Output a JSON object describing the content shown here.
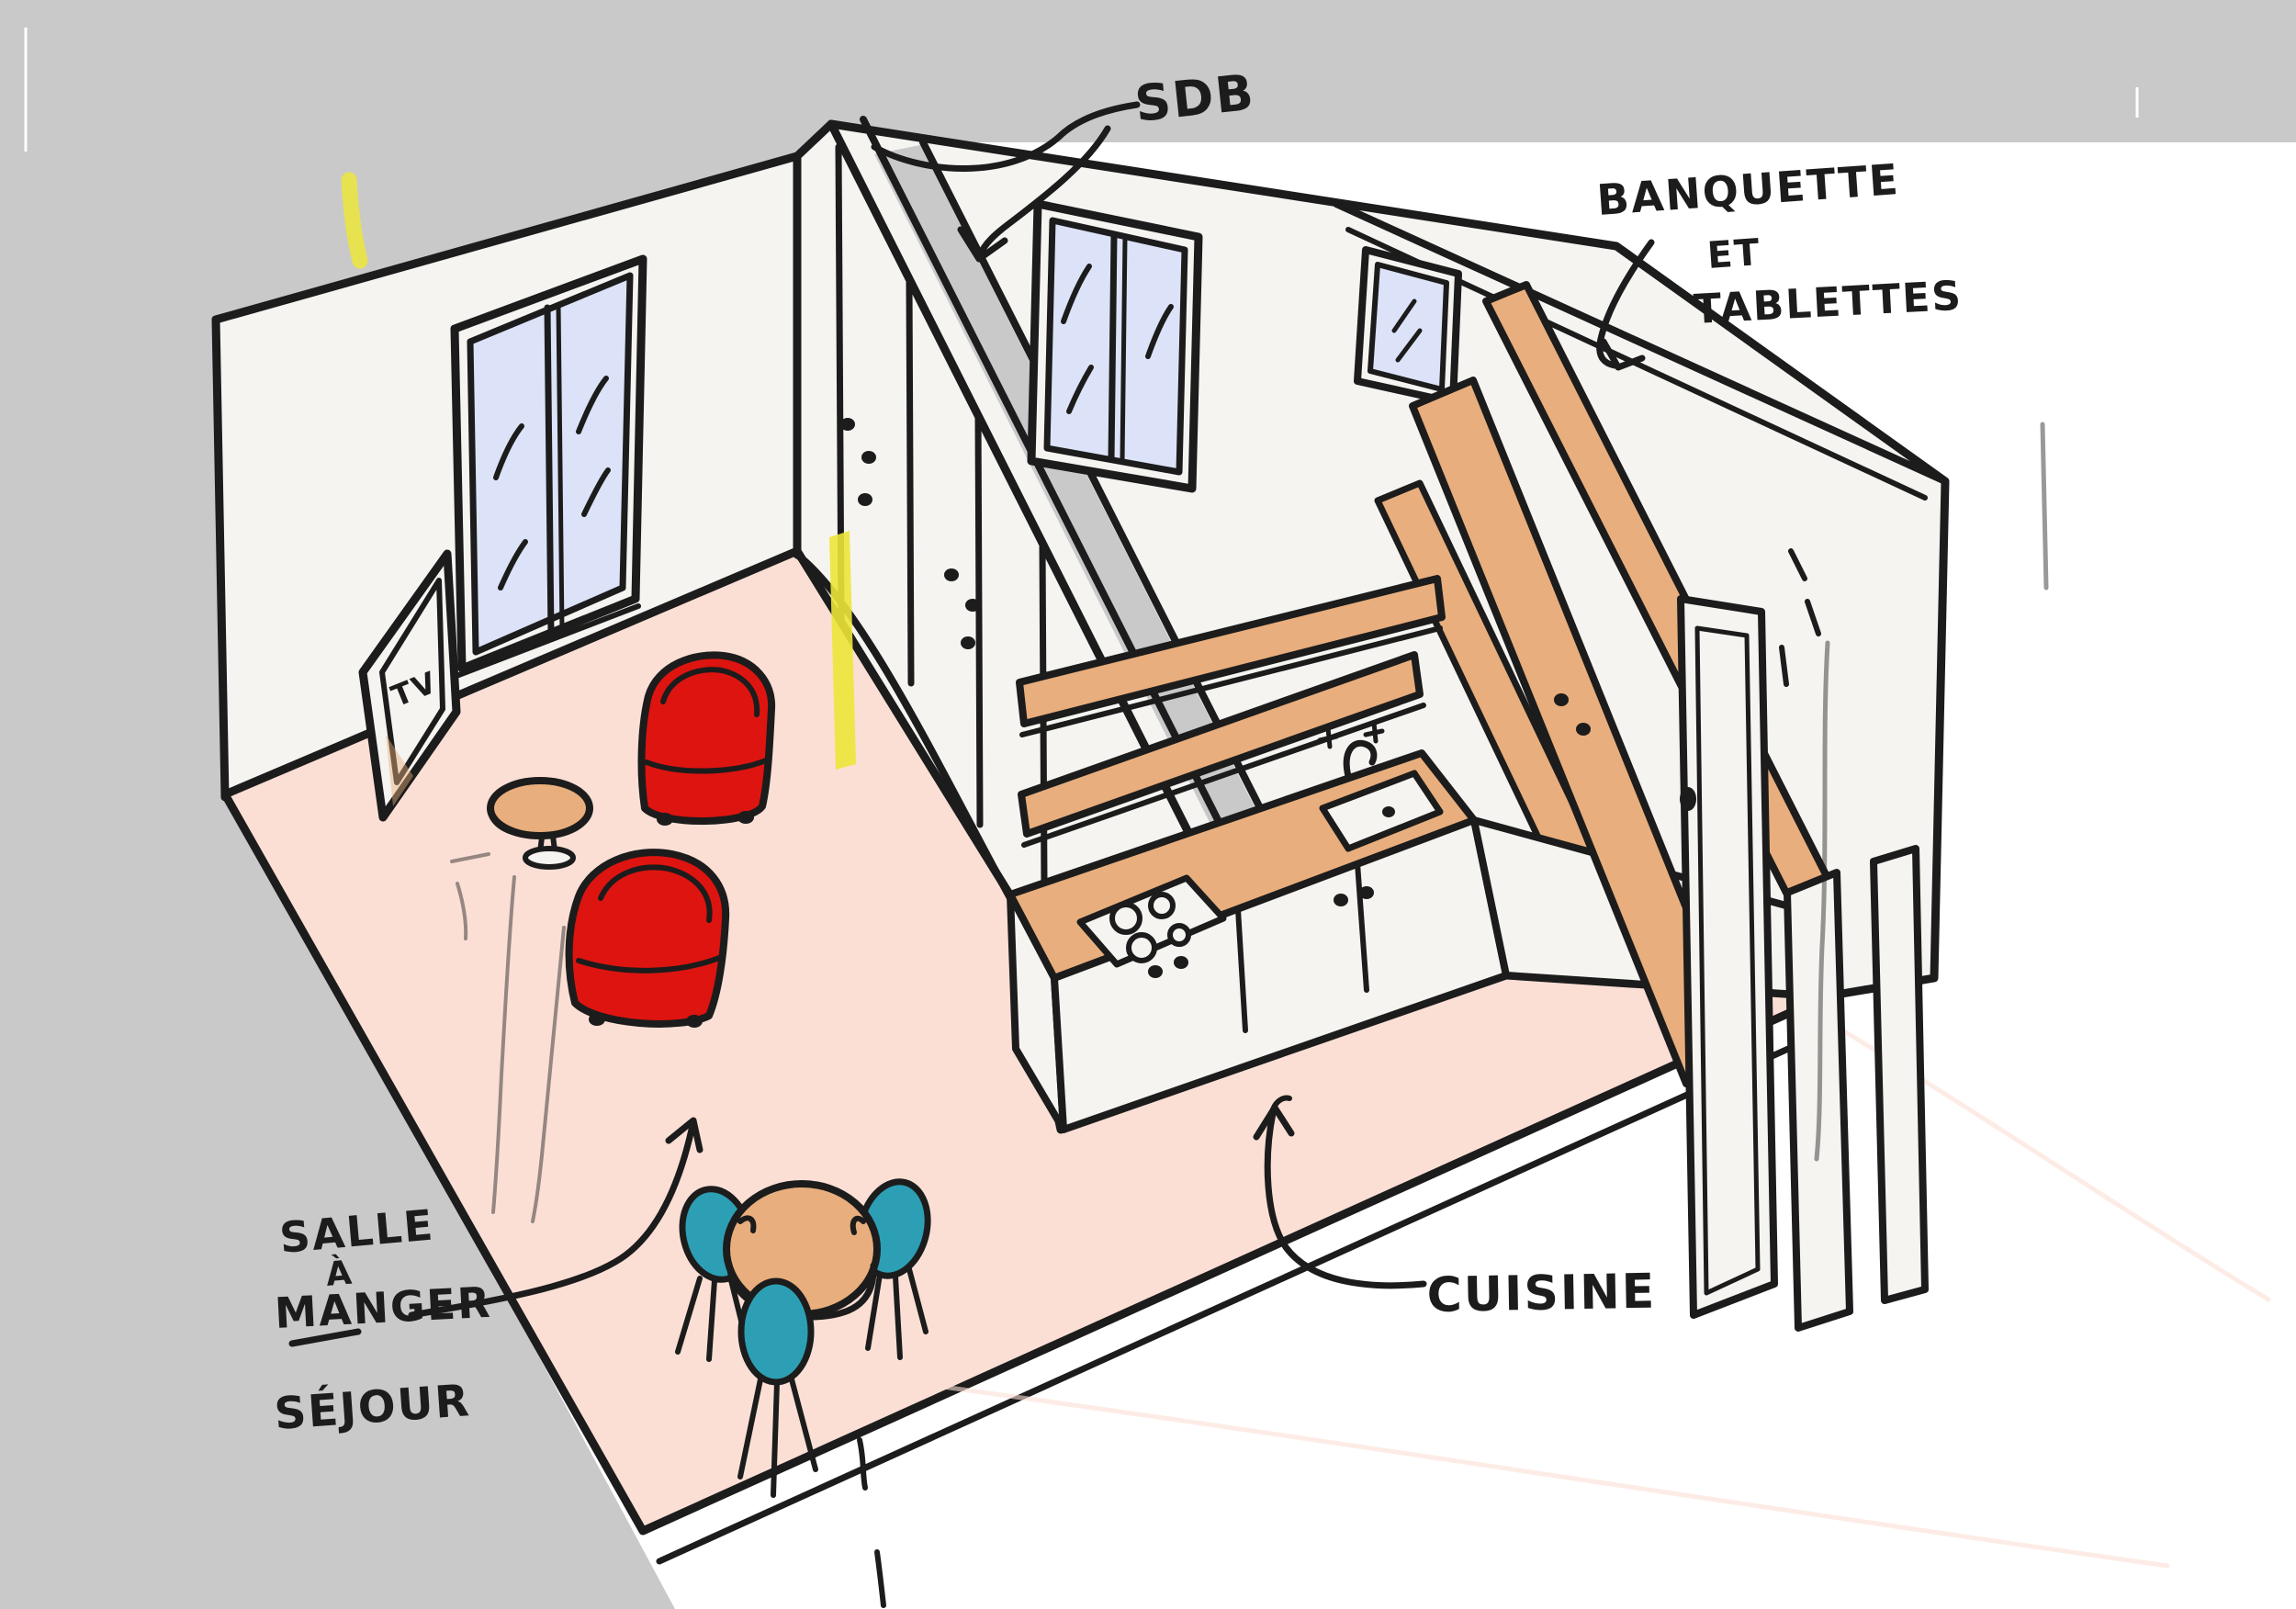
{
  "scene": {
    "type": "interior-design-sketch",
    "style": "hand-drawn isometric marker sketch",
    "subject": "small apartment layout with living room, dining area, kitchen, bathroom and banquette shelving"
  },
  "labels": {
    "bathroom": "SDB",
    "banquette_line1": "BANQUETTE",
    "banquette_line2": "ET",
    "banquette_line3": "TABLETTES",
    "dining_line1": "SALLE",
    "dining_line2": "À",
    "dining_line3": "MANGER",
    "living": "SÉJOUR",
    "kitchen": "CUISINE",
    "tv": "TV"
  },
  "colors": {
    "background_gray": "#c5c5c5",
    "paper_white": "#ffffff",
    "wall_white": "#f5f4f1",
    "floor_pink": "#fbdfd5",
    "window_blue": "#dce2f7",
    "wood_tan": "#e8ae7d",
    "chair_red": "#dd1410",
    "chair_teal": "#2d9fb5",
    "accent_yellow": "#ece63a",
    "ink_black": "#1c1c1c",
    "shadow_gray": "#c9c9c9"
  }
}
